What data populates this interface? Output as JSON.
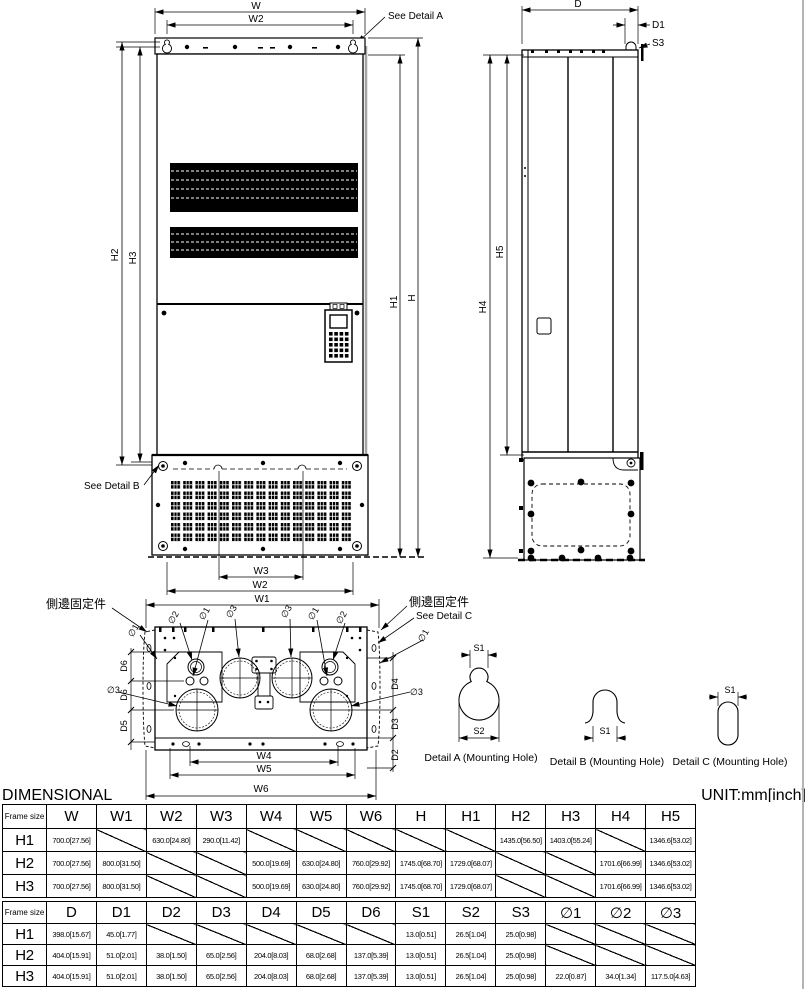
{
  "colors": {
    "line": "#000000",
    "shadow": "#a6a6a6",
    "page_edge": "#b4b4b4"
  },
  "drawing": {
    "front": {
      "dim_w": "W",
      "dim_w2_top": "W2",
      "see_detail_a": "See Detail A",
      "dim_h2": "H2",
      "dim_h3": "H3",
      "dim_h1": "H1",
      "dim_h": "H",
      "see_detail_b": "See Detail B",
      "dim_w3": "W3",
      "dim_w2_bottom": "W2",
      "dim_w1": "W1"
    },
    "side": {
      "dim_d": "D",
      "dim_d1": "D1",
      "dim_s3": "S3",
      "dim_h4": "H4",
      "dim_h5": "H5"
    },
    "bottom": {
      "label_side_fix_left": "側邊固定件",
      "label_side_fix_right": "側邊固定件",
      "see_detail_c": "See Detail C",
      "dim_phi1_outer_left": "∅1",
      "dim_phi2_tl": "∅2",
      "dim_phi1_tl": "∅1",
      "dim_phi3_tl": "∅3",
      "dim_phi3_tr": "∅3",
      "dim_phi1_tr": "∅1",
      "dim_phi2_tr": "∅2",
      "dim_phi1_outer_right": "∅1",
      "dim_d6_upper": "D6",
      "dim_d6_lower": "D6",
      "dim_d5": "D5",
      "dim_phi3_left": "∅3",
      "dim_d4": "D4",
      "dim_d3": "D3",
      "dim_d2": "D2",
      "dim_phi3_right": "∅3",
      "dim_w4": "W4",
      "dim_w5": "W5",
      "dim_w6": "W6"
    },
    "details": {
      "a_s1": "S1",
      "a_s2": "S2",
      "a_label": "Detail A (Mounting Hole)",
      "b_s1": "S1",
      "b_label": "Detail B (Mounting Hole)",
      "c_s1": "S1",
      "c_label": "Detail C (Mounting Hole)"
    }
  },
  "footer": {
    "dimensional": "DIMENSIONAL",
    "unit": "UNIT:mm[inch]"
  },
  "table1": {
    "headers": [
      "Frame size",
      "W",
      "W1",
      "W2",
      "W3",
      "W4",
      "W5",
      "W6",
      "H",
      "H1",
      "H2",
      "H3",
      "H4",
      "H5"
    ],
    "rows": [
      {
        "frame": "H1",
        "cells": [
          "700.0[27.56]",
          null,
          "630.0[24.80]",
          "290.0[11.42]",
          null,
          null,
          null,
          null,
          null,
          "1435.0[56.50]",
          "1403.0[55.24]",
          null,
          "1346.6[53.02]"
        ]
      },
      {
        "frame": "H2",
        "cells": [
          "700.0[27.56]",
          "800.0[31.50]",
          null,
          null,
          "500.0[19.69]",
          "630.0[24.80]",
          "760.0[29.92]",
          "1745.0[68.70]",
          "1729.0[68.07]",
          null,
          null,
          "1701.6[66.99]",
          "1346.6[53.02]"
        ]
      },
      {
        "frame": "H3",
        "cells": [
          "700.0[27.56]",
          "800.0[31.50]",
          null,
          null,
          "500.0[19.69]",
          "630.0[24.80]",
          "760.0[29.92]",
          "1745.0[68.70]",
          "1729.0[68.07]",
          null,
          null,
          "1701.6[66.99]",
          "1346.6[53.02]"
        ]
      }
    ]
  },
  "table2": {
    "headers": [
      "Frame size",
      "D",
      "D1",
      "D2",
      "D3",
      "D4",
      "D5",
      "D6",
      "S1",
      "S2",
      "S3",
      "∅1",
      "∅2",
      "∅3"
    ],
    "rows": [
      {
        "frame": "H1",
        "cells": [
          "398.0[15.67]",
          "45.0[1.77]",
          null,
          null,
          null,
          null,
          null,
          "13.0[0.51]",
          "26.5[1.04]",
          "25.0[0.98]",
          null,
          null,
          null
        ]
      },
      {
        "frame": "H2",
        "cells": [
          "404.0[15.91]",
          "51.0[2.01]",
          "38.0[1.50]",
          "65.0[2.56]",
          "204.0[8.03]",
          "68.0[2.68]",
          "137.0[5.39]",
          "13.0[0.51]",
          "26.5[1.04]",
          "25.0[0.98]",
          null,
          null,
          null
        ]
      },
      {
        "frame": "H3",
        "cells": [
          "404.0[15.91]",
          "51.0[2.01]",
          "38.0[1.50]",
          "65.0[2.56]",
          "204.0[8.03]",
          "68.0[2.68]",
          "137.0[5.39]",
          "13.0[0.51]",
          "26.5[1.04]",
          "25.0[0.98]",
          "22.0[0.87]",
          "34.0[1.34]",
          "117.5.0[4.63]"
        ]
      }
    ]
  }
}
